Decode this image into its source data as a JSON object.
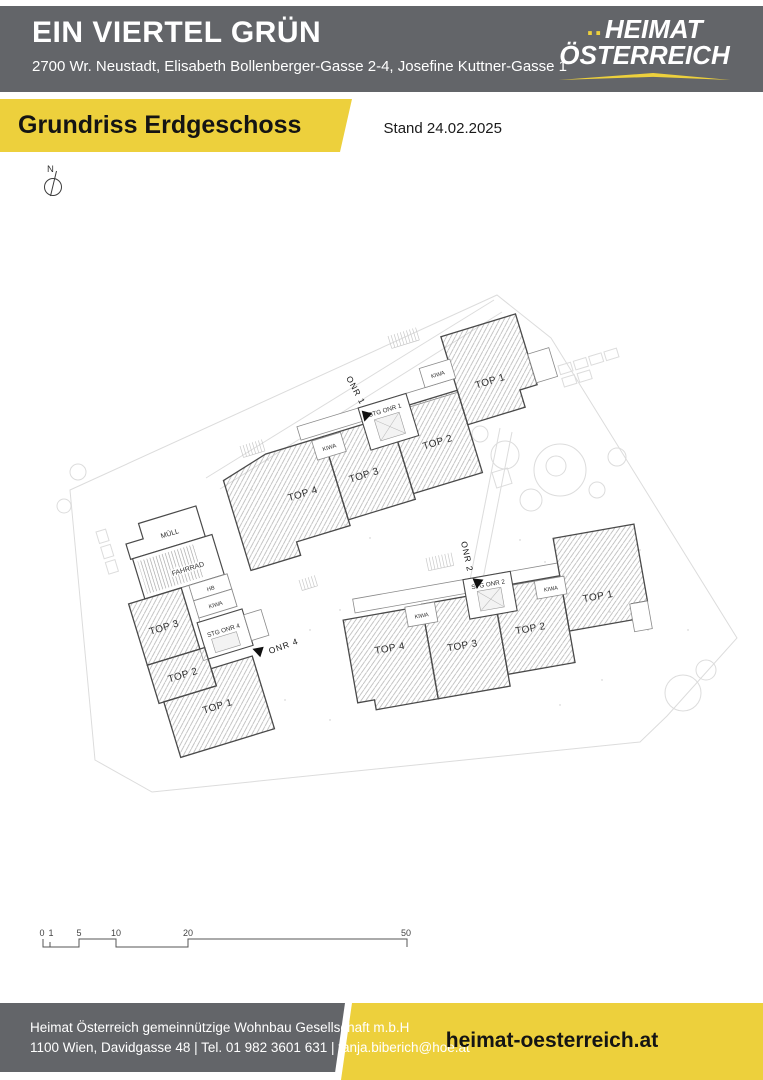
{
  "header": {
    "title": "EIN VIERTEL GRÜN",
    "address": "2700 Wr. Neustadt, Elisabeth Bollenberger-Gasse 2-4, Josefine Kuttner-Gasse 1"
  },
  "logo": {
    "dots": "..",
    "line1": "HEIMAT",
    "line2": "ÖSTERREICH"
  },
  "banner": {
    "title": "Grundriss Erdgeschoss",
    "stand": "Stand 24.02.2025"
  },
  "plan": {
    "north_label": "N",
    "onr1": {
      "name": "ONR 1",
      "stg": "STG ONR 1",
      "top1": "TOP 1",
      "top2": "TOP 2",
      "top3": "TOP 3",
      "top4": "TOP 4",
      "kiwa_a": "KIWA",
      "kiwa_b": "KIWA"
    },
    "onr2": {
      "name": "ONR 2",
      "stg": "STG ONR 2",
      "top1": "TOP 1",
      "top2": "TOP 2",
      "top3": "TOP 3",
      "top4": "TOP 4",
      "kiwa_a": "KIWA",
      "kiwa_b": "KIWA"
    },
    "onr4": {
      "name": "ONR 4",
      "stg": "STG ONR 4",
      "top1": "TOP 1",
      "top2": "TOP 2",
      "top3": "TOP 3",
      "muell": "MÜLL",
      "fahrrad": "FAHRRAD",
      "hb": "HB",
      "kiwa": "KIWA"
    },
    "scale": {
      "l0": "0",
      "l1": "1",
      "l5": "5",
      "l10": "10",
      "l20": "20",
      "l50": "50"
    }
  },
  "footer": {
    "company": "Heimat Österreich gemeinnützige Wohnbau Gesellschaft m.b.H",
    "contact": "1100 Wien, Davidgasse 48 | Tel. 01 982 3601 631 | tanja.biberich@hoe.at",
    "website": "heimat-oesterreich.at"
  },
  "colors": {
    "brand_gray": "#636569",
    "brand_yellow": "#edd03c"
  }
}
